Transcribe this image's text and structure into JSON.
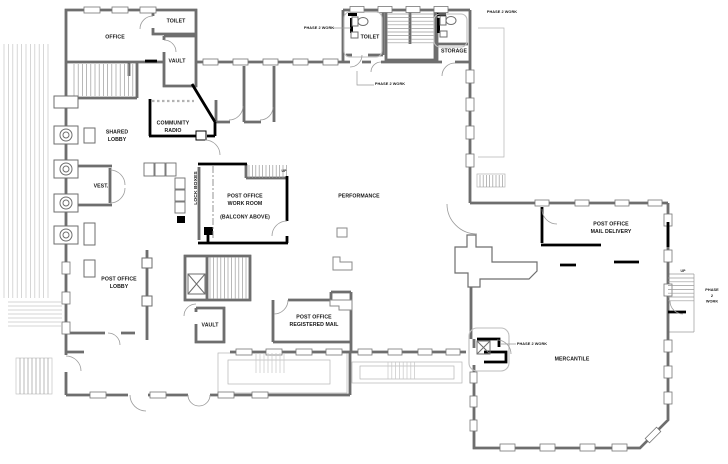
{
  "plan": {
    "title": "First floor plan",
    "labels": {
      "office": "OFFICE",
      "toilet_1": "TOILET",
      "vault_1": "VAULT",
      "community_radio": "COMMUNITY\nRADIO",
      "shared_lobby": "SHARED\nLOBBY",
      "vest": "VEST.",
      "lock_boxes": "LOCK BOXES",
      "po_work_room": "POST OFFICE\nWORK ROOM",
      "balcony_above": "(BALCONY ABOVE)",
      "up_1": "UP",
      "performance": "PERFORMANCE",
      "po_lobby": "POST OFFICE\nLOBBY",
      "vault_2": "VAULT",
      "po_registered_mail": "POST OFFICE\nREGISTERED MAIL",
      "toilet_2": "TOILET",
      "storage": "STORAGE",
      "po_mail_delivery": "POST OFFICE\nMAIL DELIVERY",
      "mercantile": "MERCANTILE",
      "up_2": "UP",
      "phase2_a": "PHASE 2 WORK",
      "phase2_b": "PHASE 2 WORK",
      "phase2_c": "PHASE 2 WORK",
      "phase2_d": "PHASE 2 WORK",
      "phase2_e": "PHASE 2 WORK"
    },
    "colors": {
      "existing_wall": "#6e6e6e",
      "new_wall": "#000000",
      "site_lines": "#bdbdbd",
      "paper": "#ffffff"
    }
  }
}
